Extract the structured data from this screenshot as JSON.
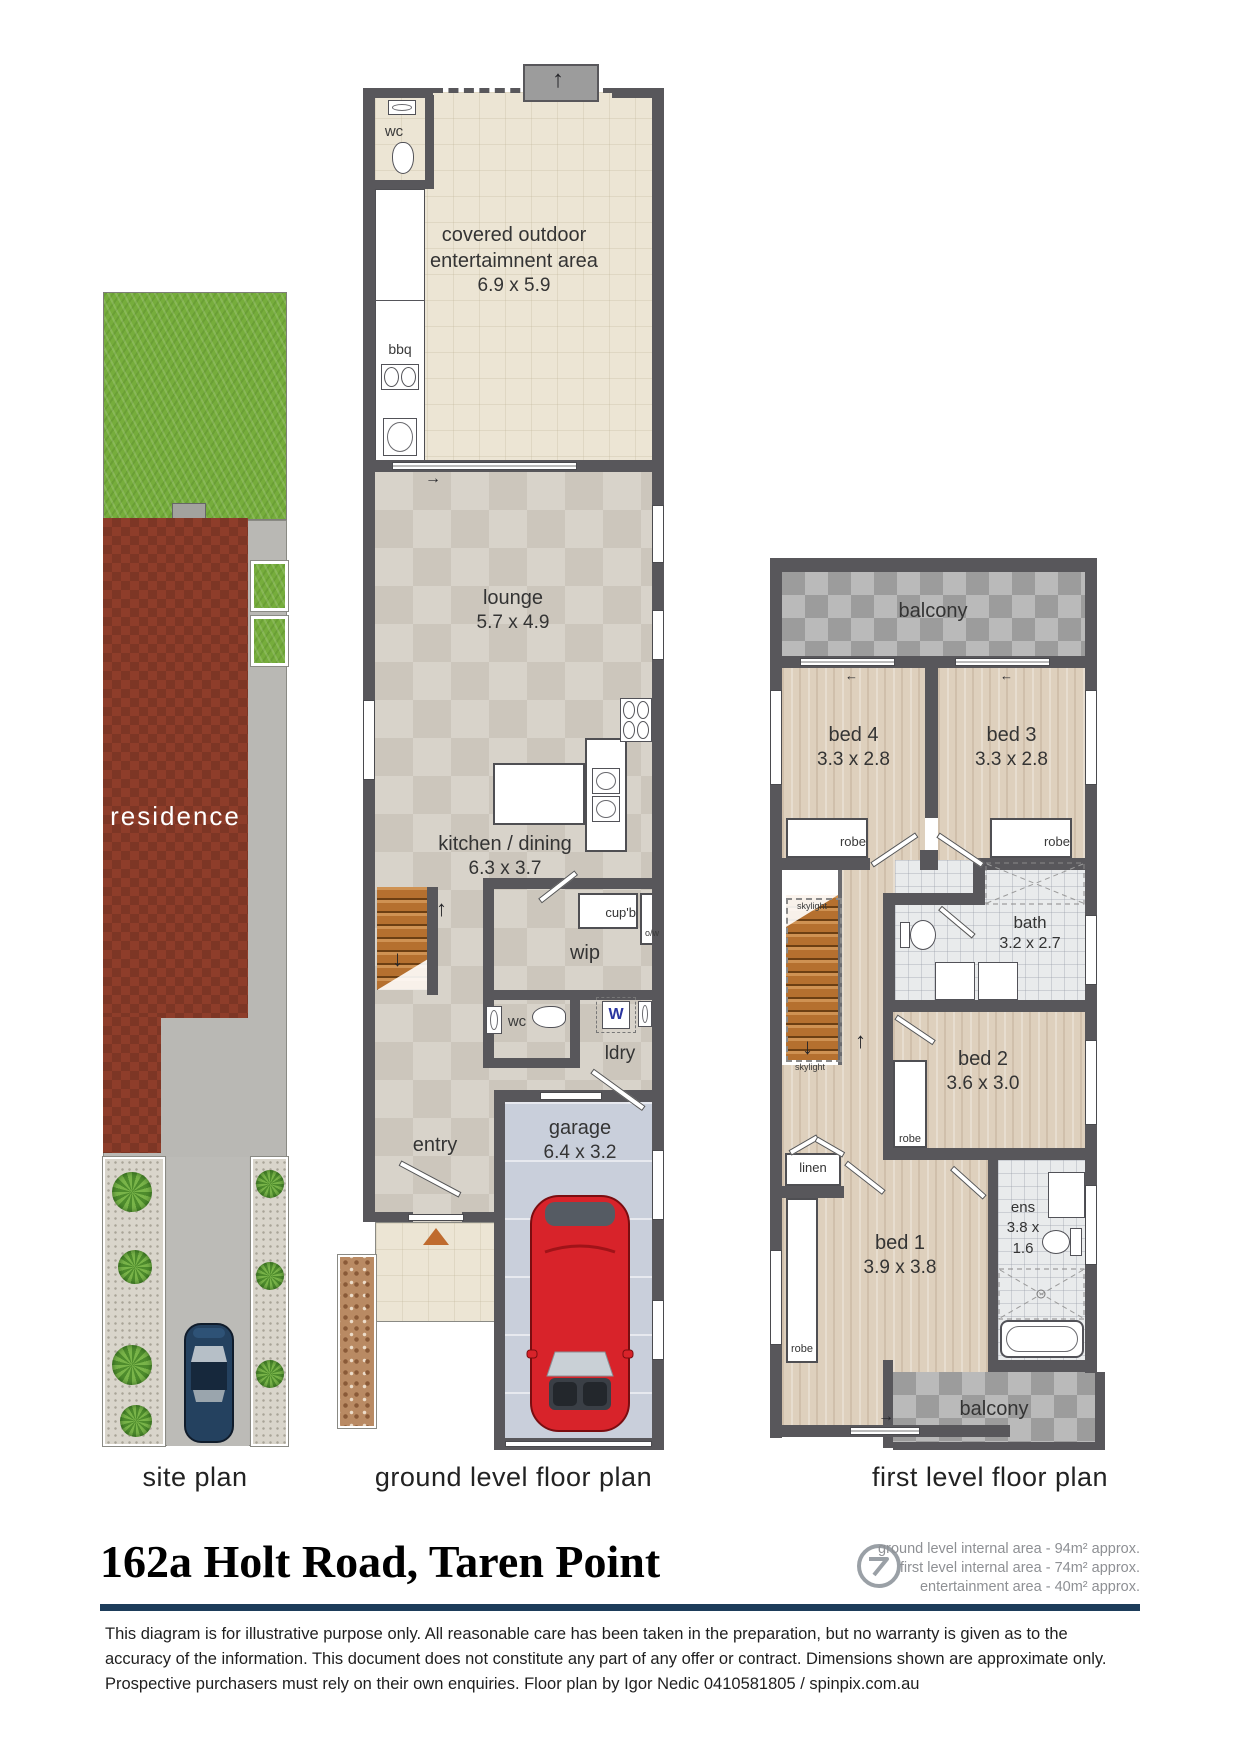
{
  "page": {
    "title": "162a Holt Road, Taren Point",
    "captions": {
      "site": "site plan",
      "ground": "ground level floor plan",
      "first": "first level floor plan"
    },
    "area_summary": [
      "ground level internal area - 94m² approx.",
      "first level internal area - 74m² approx.",
      "entertainment area - 40m² approx."
    ],
    "disclaimer": "This diagram is for illustrative purpose only. All reasonable care has been taken in the preparation, but no warranty is given as to the accuracy of the information. This document does not constitute any part of any offer or contract. Dimensions shown are approximate only. Prospective purchasers must rely on their own enquiries. Floor plan by Igor Nedic 0410581805 / spinpix.com.au"
  },
  "site": {
    "residence": "residence"
  },
  "ground": {
    "wc": "wc",
    "bbq": "bbq",
    "entertainment": {
      "name1": "covered outdoor",
      "name2": "entertaimnent area",
      "dims": "6.9 x 5.9"
    },
    "lounge": {
      "name": "lounge",
      "dims": "5.7 x 4.9"
    },
    "kitchen": {
      "name": "kitchen / dining",
      "dims": "6.3 x 3.7"
    },
    "cupb": "cup'b",
    "ow": "o/w",
    "wip": "wip",
    "washer": "W",
    "ldry": "ldry",
    "entry": "entry",
    "garage": {
      "name": "garage",
      "dims": "6.4 x 3.2"
    }
  },
  "first": {
    "balcony": "balcony",
    "bed4": {
      "name": "bed 4",
      "dims": "3.3 x 2.8"
    },
    "bed3": {
      "name": "bed 3",
      "dims": "3.3 x 2.8"
    },
    "robe": "robe",
    "skylight": "skylight",
    "bath": {
      "name": "bath",
      "dims": "3.2 x 2.7"
    },
    "bed2": {
      "name": "bed 2",
      "dims": "3.6 x 3.0"
    },
    "linen": "linen",
    "bed1": {
      "name": "bed 1",
      "dims": "3.9 x 3.8"
    },
    "ens": {
      "name": "ens",
      "dims1": "3.8 x",
      "dims2": "1.6"
    }
  },
  "icons": {
    "up_arrow": "↑",
    "down_arrow": "↓",
    "left_arrow": "←",
    "right_arrow": "→"
  },
  "colors": {
    "wall": "#58575b",
    "navy_rule": "#1d3c5a",
    "residence_red": "#8e3d2a",
    "grass_green": "#76ad3c",
    "garage_floor": "#c9cfdb",
    "stair_wood": "#b5702f",
    "red_car": "#d8232a",
    "blue_car": "#2a4a70"
  }
}
